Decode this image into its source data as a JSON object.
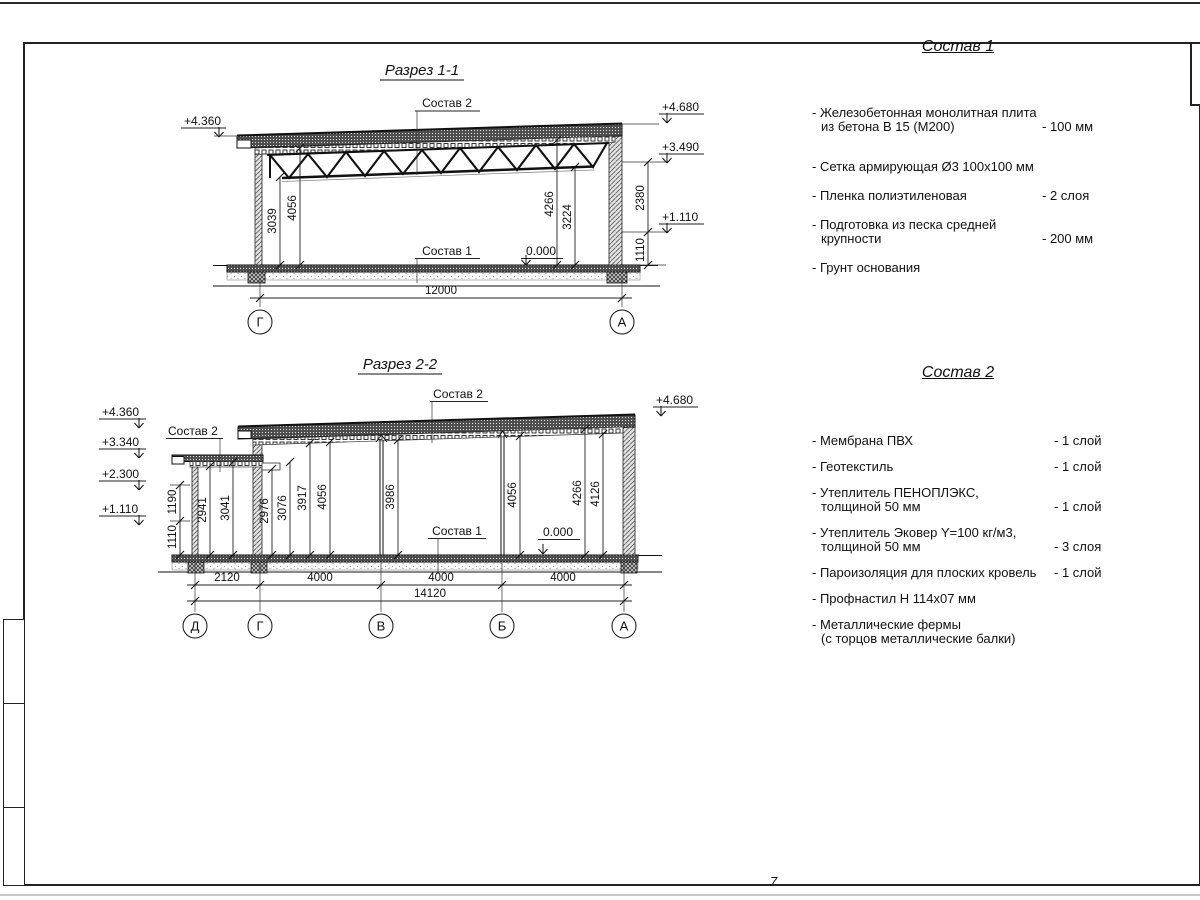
{
  "page": {
    "number": "7"
  },
  "s1": {
    "title": "Разрез 1-1",
    "sostav2": "Состав 2",
    "sostav1": "Состав 1",
    "zero": "0.000",
    "elev_left": "+4.360",
    "elev_r1": "+4.680",
    "elev_r2": "+3.490",
    "elev_r3": "+1.110",
    "d1": "3039",
    "d2": "4056",
    "d3": "4266",
    "d4": "3224",
    "dr1": "2380",
    "dr2": "1110",
    "total": "12000",
    "ax1": "Г",
    "ax2": "А"
  },
  "s2": {
    "title": "Разрез 2-2",
    "sostav2_annex": "Состав 2",
    "sostav2_main": "Состав 2",
    "sostav1": "Состав 1",
    "zero": "0.000",
    "el1": "+4.360",
    "el2": "+3.340",
    "el3": "+2.300",
    "el4": "+1.110",
    "elr": "+4.680",
    "w1": "1190",
    "w2": "1110",
    "d1": "2941",
    "d2": "3041",
    "d3": "2976",
    "d4": "3076",
    "d5": "3917",
    "d6": "4056",
    "d7": "3986",
    "d8": "4056",
    "d9": "4266",
    "d10": "4126",
    "b1": "2120",
    "b2": "4000",
    "b3": "4000",
    "b4": "4000",
    "total": "14120",
    "ax1": "Д",
    "ax2": "Г",
    "ax3": "В",
    "ax4": "Б",
    "ax5": "А"
  },
  "lists": {
    "sostav1": {
      "title": "Состав 1",
      "items": [
        {
          "line1": "- Железобетонная  монолитная плита",
          "line2": "из бетона В 15 (М200)",
          "value": "- 100 мм"
        },
        {
          "line1": "- Сетка армирующая Ø3 100х100 мм",
          "value": ""
        },
        {
          "line1": "- Пленка полиэтиленовая",
          "value": "-  2 слоя"
        },
        {
          "line1": "- Подготовка из песка средней",
          "line2": "крупности",
          "value": "- 200 мм"
        },
        {
          "line1": "- Грунт основания",
          "value": ""
        }
      ]
    },
    "sostav2": {
      "title": "Состав 2",
      "items": [
        {
          "line1": "- Мембрана ПВХ",
          "value": "- 1 слой"
        },
        {
          "line1": "- Геотекстиль",
          "value": "- 1 слой"
        },
        {
          "line1": "- Утеплитель ПЕНОПЛЭКС,",
          "line2": "толщиной 50 мм",
          "value": "- 1 слой"
        },
        {
          "line1": "- Утеплитель Эковер Y=100 кг/м3,",
          "line2": "толщиной 50 мм",
          "value": "- 3 слоя"
        },
        {
          "line1": "- Пароизоляция для плоских кровель",
          "value": "- 1 слой"
        },
        {
          "line1": "- Профнастил Н 114х07 мм",
          "value": ""
        },
        {
          "line1": "- Металлические фермы",
          "line2": "(с торцов металлические балки)",
          "value": ""
        }
      ]
    }
  }
}
